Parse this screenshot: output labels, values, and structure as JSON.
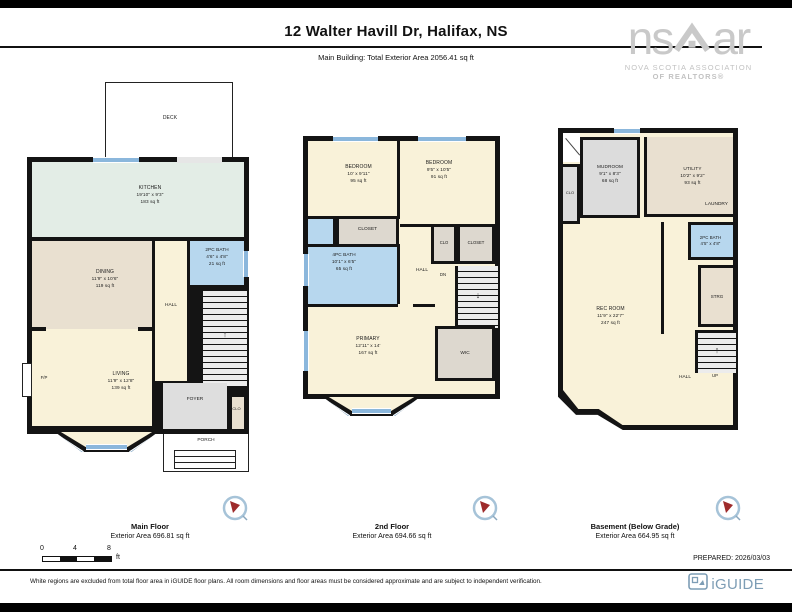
{
  "header": {
    "title": "12 Walter Havill Dr, Halifax, NS",
    "subtitle": "Main Building: Total Exterior Area 2056.41 sq ft"
  },
  "nsar": {
    "left": "ns",
    "right": "ar",
    "line1": "NOVA SCOTIA ASSOCIATION",
    "line2": "OF REALTORS®"
  },
  "floors": [
    {
      "caption": {
        "name": "Main Floor",
        "area": "Exterior Area 696.81 sq ft"
      },
      "rooms": {
        "deck": {
          "name": "DECK"
        },
        "kitchen": {
          "name": "KITCHEN",
          "dims": "19'10\" x 9'3\"",
          "area": "183 sq ft"
        },
        "bath": {
          "name": "2PC BATH",
          "dims": "4'6\" x 4'8\"",
          "area": "21 sq ft"
        },
        "dining": {
          "name": "DINING",
          "dims": "11'9\" x 10'6\"",
          "area": "119 sq ft"
        },
        "living": {
          "name": "LIVING",
          "dims": "11'9\" x 12'8\"",
          "area": "139 sq ft"
        },
        "hall": {
          "name": "HALL"
        },
        "fp": {
          "name": "F/P"
        },
        "up": {
          "name": "UP"
        },
        "foyer": {
          "name": "FOYER"
        },
        "clo": {
          "name": "CLO"
        },
        "porch": {
          "name": "PORCH"
        }
      }
    },
    {
      "caption": {
        "name": "2nd Floor",
        "area": "Exterior Area 694.66 sq ft"
      },
      "rooms": {
        "bedroom1": {
          "name": "BEDROOM",
          "dims": "10' x 9'11\"",
          "area": "95 sq ft"
        },
        "bedroom2": {
          "name": "BEDROOM",
          "dims": "9'5\" x 10'5\"",
          "area": "91 sq ft"
        },
        "closet1": {
          "name": "CLOSET"
        },
        "clo": {
          "name": "CLO"
        },
        "closet2": {
          "name": "CLOSET"
        },
        "bath": {
          "name": "4PC BATH",
          "dims": "10'1\" x 6'5\"",
          "area": "65 sq ft"
        },
        "hall": {
          "name": "HALL"
        },
        "dn": {
          "name": "DN"
        },
        "primary": {
          "name": "PRIMARY",
          "dims": "12'11\" x 14'",
          "area": "167 sq ft"
        },
        "wic": {
          "name": "WIC"
        }
      }
    },
    {
      "caption": {
        "name": "Basement (Below Grade)",
        "area": "Exterior Area 664.95 sq ft"
      },
      "rooms": {
        "mudroom": {
          "name": "MUDROOM",
          "dims": "9'1\" x 8'3\"",
          "area": "68 sq ft"
        },
        "clo": {
          "name": "CLO"
        },
        "utility": {
          "name": "UTILITY",
          "dims": "10'2\" x 9'2\"",
          "area": "93 sq ft"
        },
        "laundry": {
          "name": "LAUNDRY"
        },
        "bath": {
          "name": "2PC BATH",
          "dims": "4'5\" x 4'8\""
        },
        "strg": {
          "name": "STRG"
        },
        "rec": {
          "name": "REC ROOM",
          "dims": "11'9\" x 22'7\"",
          "area": "247 sq ft"
        },
        "hall": {
          "name": "HALL"
        },
        "up": {
          "name": "UP"
        }
      }
    }
  ],
  "footer": {
    "scale": {
      "n0": "0",
      "n4": "4",
      "n8": "8",
      "unit": "ft"
    },
    "prepared": "PREPARED: 2026/03/03",
    "disclaimer": "White regions are excluded from total floor area in iGUIDE floor plans. All room dimensions and floor areas must be considered approximate and are subject to independent verification.",
    "brand": "iGUIDE"
  },
  "colors": {
    "wall": "#141414",
    "cream": "#f9f2d9",
    "tan": "#e9e0d0",
    "mint": "#e3ede6",
    "bath_blue": "#b7d7ee",
    "gray": "#dcdcdc",
    "window": "#8bb7dc",
    "nsar_gray": "#c9c9c9",
    "iguide": "#7d9db5",
    "compass_needle": "#9e2b2b"
  }
}
